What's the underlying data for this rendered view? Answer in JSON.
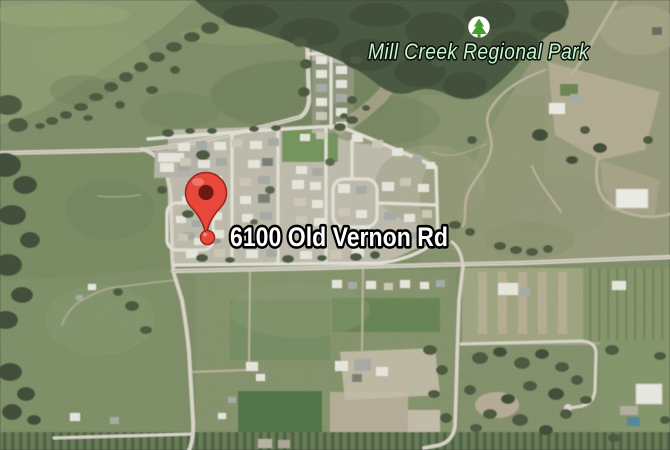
{
  "map": {
    "view_type": "satellite",
    "park_label": {
      "text": "Mill Creek Regional Park",
      "icon": "tree-icon",
      "text_color": "#c8f5cf",
      "icon_color": "#469c2e"
    },
    "address_label": {
      "text": "6100 Old Vernon Rd",
      "text_color": "#ffffff"
    },
    "marker": {
      "type": "red-pin",
      "body_color": "#e8473b",
      "inner_color": "#6b1a12",
      "outline_color": "#9a281e"
    }
  }
}
